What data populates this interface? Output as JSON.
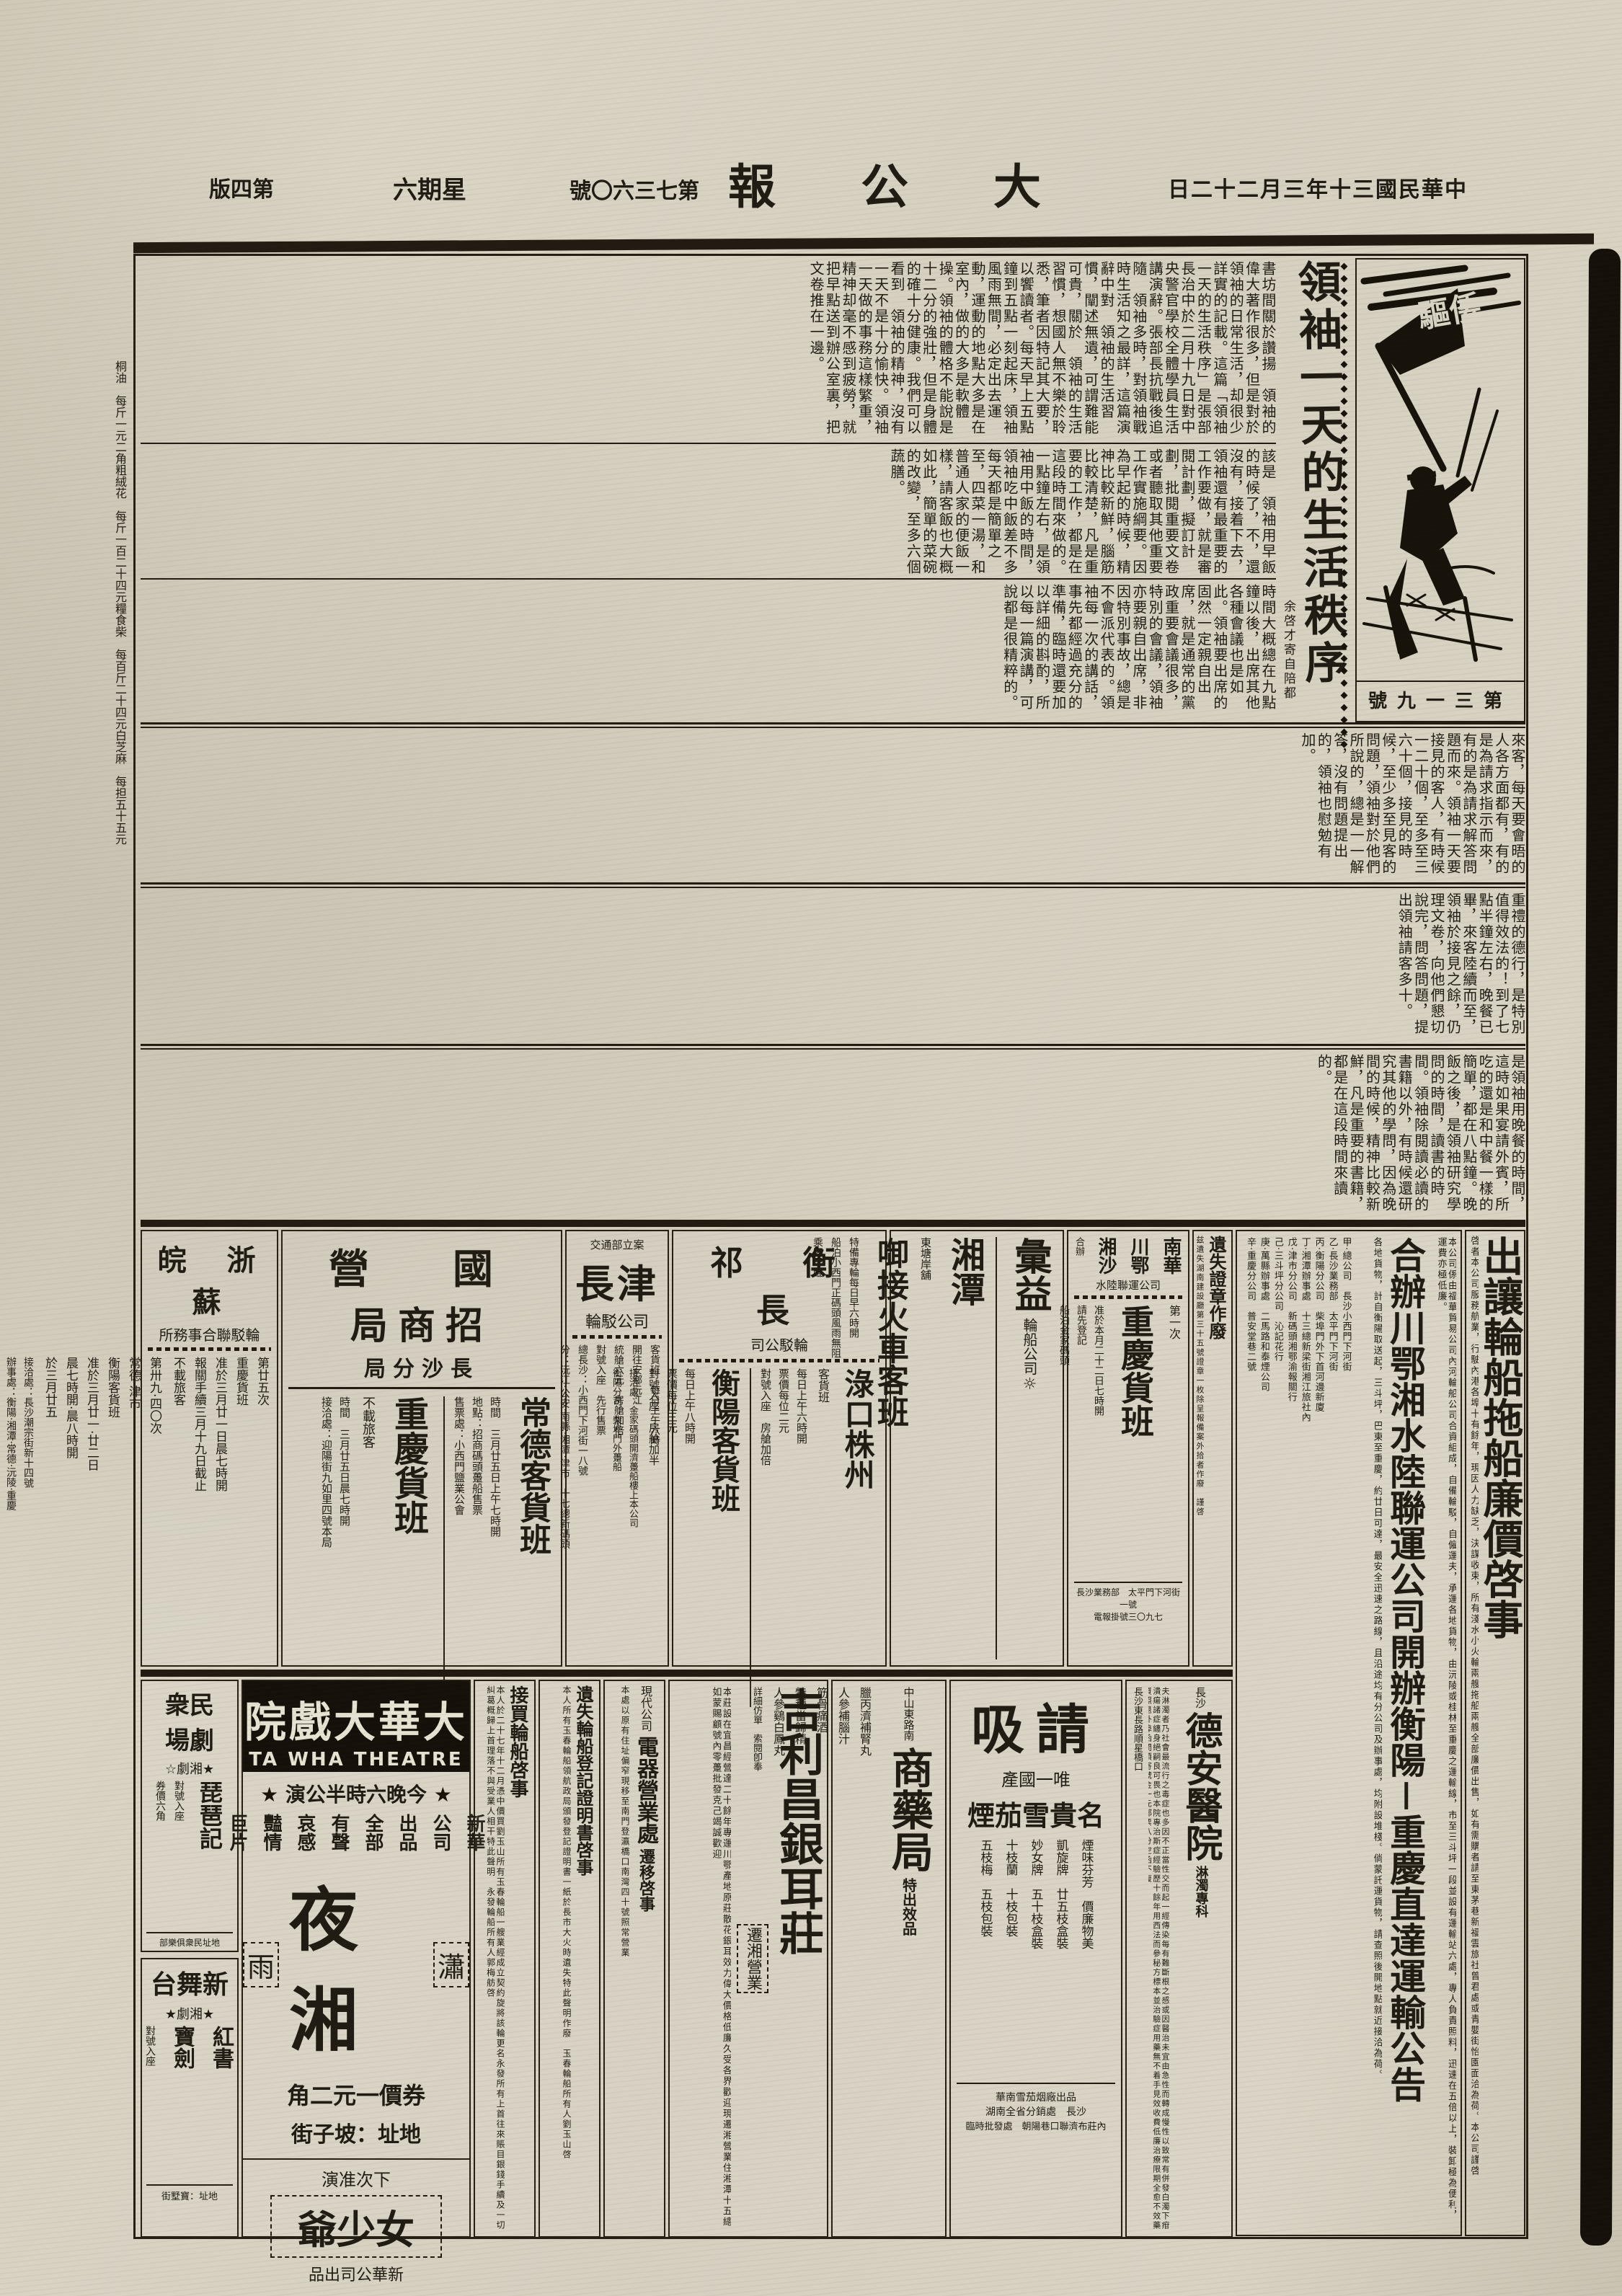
{
  "masthead": {
    "date_display": "日二十二月三年十三國民華中",
    "title_display": "報　公　大",
    "issue_display": "號〇六三七第",
    "weekday_display": "六期星",
    "edition_display": "版四第"
  },
  "prices": {
    "items": "桐油　每斤一元二角｜粗絨花　每斤一百二十四元｜糧食｜柴　每百斤二十四元｜白芝麻　每担五十五元"
  },
  "lead": {
    "headline": "領袖一天的生活秩序",
    "byline": "余啓才寄自陪都",
    "cartoon_flag": "驅倭",
    "cartoon_caption": "號九一三第",
    "row1": "書坊間關於讚揚　領袖的偉大著作很多，但是對於　領袖的日常生活，却很少詳實的記載。這篇「領袖一天的生活秩序」是張部長治中於二月十九日對中央警官學校全體學員生活講演辭。張部長抗戰後追隨　領袖多時，對領袖戰時生活知之最詳，這篇演辭中對　領袖的生活習慣，闡述無遺，可謂難能可貴，關於　領袖的生活習慣，想國人無不樂於聆悉，筆者因特記其大要，以饗讀者。每天早上五點鐘到五點一刻起床，領袖風雨無間，必定出去運動，運動的地點大多是在室內，做的大多是軟體操。領袖的體格不能說是十二分的強壯，但是身體的確十分健康。我們可以看到　領袖的精神，沒有一天不是十分愉快。領袖一天做的事務這樣繁重，精神却毫不感到疲勞，就把早點送到辦公室裏，把文卷推在一邊。",
    "row2": "該是　領袖用早飯的時候了，不，還沒有，接着下去，領袖還有最重要的工作要做，就是審閱計劃，擬訂計劃，批閱重要文卷或者聽取其他重要工作實施綱要。因為早起的時候，精神比較新鮮，腦筋比較清楚，凡是重要的工作，都是在這段時間來做的。一點鐘左右，是領袖用中飯的時間，領袖吃中飯差不多每天都是簡單之至，四菜一湯，和普通人家的便飯一樣，請客飯也大概如此，簡單的菜碗的改變，至多六個蔬膳。",
    "row3": "時間大概總在九點鐘以後，出席其他各種會議也是如此。領袖要出席的固然一定親自出席，就是通常的黨政重要會議很多，特別的會議，領袖亦要親自出席，非因特別事故，總是不會派代表的。領袖每一次的講話，事先都經過充分的準備，臨時還要加以詳細的斟酌，所以每一篇演講，可說都是很精粹的。"
  },
  "bands": {
    "b2": "來客，每天要會晤的人各方面都有，有的是為請求指示而來，有的是為請求解答問題而來。領袖一天要接見的客人，有時候一二十個，至多至三六十個，接見的時候，至少多至見客的問題，領袖對於他們所說的，總是一一解答，沒有問題提出的，領袖也慰勉有加。",
    "b3": "重禮的德行，是特別值得效法的！到了七點半鐘左右，晚餐已畢，來客陸續而至，領袖於接見之餘，仍理文卷，向他們懇切說完，問答問題，提出領袖請客多十。",
    "b4": "是領袖用晚餐的時間，這時如果宴請外賓，所吃的還是和中餐一樣的簡單，都在八點鐘。晚飯之後，是領袖研究學問的時間，讀書的時間。領袖除閱讀必讀的書籍以外，有時候還研究其他的學問，因為晚間的時候，精神比較新鮮，凡是重要的書籍，都是在這段時間來讀的。"
  },
  "right_ads": {
    "churang": {
      "headline": "出讓輪船拖船廉價啓事",
      "body": "啓者本公司服務航業，行駛內港各埠十有餘年，現因人力缺乏，決謀收束，所有淺水小火輪兩艘拖船兩艘全部廉價出售，如有需購者請至東茅巷新福雲旅社曾君處或青嬰街怡園面洽為荷。本公司謹啓"
    },
    "gonggao": {
      "intro": "本公司係由福華貿易公司內河輪船公司合資組成，自備輪駁，自僱運夫，承運各地貨物，由沅陵或桂林至重慶之運輸線，市至三斗坪一段並設有運輸站六處，專人負責照料，迅速在五倍以上，裝卸極為便利，運費亦極低廉。",
      "headline": "合辦川鄂湘水陸聯運公司開辦衡陽－重慶直達運輸公告",
      "body": "各地貨物，計自衡陽取送起，三斗坪，巴東至重慶，約廿日可達，最安全迅速之路線，且沿途均有分公司及辦事處，均附設堆棧。倘蒙託運貨物，請查照後開地點就近接洽為荷。",
      "offices": "甲·總公司　長沙小西門下河街｜乙·長沙業務部　太平門下河街｜丙·衡陽分公司　柴埠門外下首河邊新廈｜丁·湘潭辦事處　十三總新梁街湘江旅社內｜戊·津市分公司　新碼頭湘鄂渝報關行｜己·三斗坪分公司　沁記花行｜庚·萬縣辦事處　二馬路和泰煙公司｜辛·重慶分公司　普安堂巷二號"
    }
  },
  "mid_ads": {
    "suzhewan": {
      "region": "皖　浙　蘇",
      "title": "所務事合聯駁輪",
      "c1": "第廿五次｜重慶貨班｜准於三月廿一日晨七時開｜報關手續三月十九日截止｜不載旅客",
      "c2": "第卅九·四〇次｜常德·津市｜衡陽客貨班｜准於三月廿一·廿二日｜晨七時開·晨八時開｜於三月廿五",
      "c3": "接洽處：長沙潮宗街新十四號｜辦事處：衡陽·湘潭·常德·沅陵·重慶"
    },
    "zhaoshang": {
      "t1": "營　國",
      "t2": "局商招",
      "t3": "局分沙長",
      "a_title": "常德客貨班",
      "a_cols": "時間　三月廿五日上午七時開｜地點：招商碼頭躉船售票｜售票處：小西門鹽業公會",
      "b_title": "重慶貨班",
      "b_note": "不載旅客",
      "b_cols": "時間　三月廿五日晨七時開｜接洽處：迎陽街九如里四號本局"
    },
    "changjin": {
      "t1": "交通部立案",
      "t2": "長津",
      "t3": "輪駁公司",
      "cols": "客貨班　每日上午六時｜開往安鄉沅江｜統艙六元　房艙加倍｜對號入座　先行售票｜總長沙：小西門下河街一八號｜分：沅江·公安·南縣·湘潭·津市　十七總新碼頭"
    },
    "changhengqi": {
      "t1": "祁　衡　長",
      "t2": "司公駁輪",
      "a_title": "淥口株州",
      "a_tag": "客貨班",
      "a_cols": "每日上午六時開｜票價每位二元｜對號入座　房艙加倍",
      "b_title": "衡陽客貨班",
      "b_cols": "每日上午八時開｜票價每位三元｜對號入座　房艙加半",
      "c_cols": "接洽處：金家碼頭開濟躉船樓上本公司｜衡陽分司：柴埠門外躉船"
    },
    "huiyi": {
      "t1": "彙益",
      "t2": "輪船公司",
      "a_title": "湘潭",
      "a_small": "東塘岸舖",
      "b_title": "啣接火車客班",
      "cols": "特備專輪每日早六時開｜船泊小西門正碼頭風雨無阻｜乘客早臨"
    },
    "nanhua": {
      "t_cols": "南華｜川鄂｜湘沙",
      "t_small": "合辦",
      "t_sub": "水陸聯運公司",
      "a_small": "第一次",
      "a_title": "重慶貨班",
      "cols": "准於本月二十二日七時開｜請先登記｜船泊金家碼頭",
      "f1": "長沙業務部　太平門下河街一號",
      "f2": "電報掛號三〇九七"
    },
    "zhengzhang": {
      "title": "遺失證章作廢",
      "body": "兹遺失湖南建設廳第三十五號證章一枚除呈報備案外拾者作廢　謹啓"
    }
  },
  "bottom_ads": {
    "theaters": {
      "t1_r1": "衆民",
      "t1_r2": "場劇",
      "t1_tag": "☆劇湘★",
      "t1_play": "琵琶記",
      "t1_c": "對號入座｜券價六角",
      "t1_addr": "部樂俱衆民址地",
      "t2": "台舞新",
      "t2_tag": "★劇湘★",
      "t2_plays": "紅書｜寶劍",
      "t2_c": "對號入座",
      "t2_addr": "街墅寶：址地"
    },
    "dahua": {
      "banner": "院戲大華大",
      "banner_en": "TA WHA THEATRE",
      "showtime": "演公半時六晚今",
      "tags": "新華｜公司｜出品｜全部｜有聲｜哀感｜豔情｜巨片",
      "m_left": "雨",
      "m_big": "夜湘",
      "m_right": "瀟",
      "price": "角二元一價券",
      "addr": "街子坡：址地",
      "next_label": "演准次下",
      "next_title": "爺少女",
      "next_sub": "品出司公華新"
    },
    "jiemai": {
      "title": "接買輪船啓事",
      "body": "本人於二十七年十二月憑中價買劉玉山所有玉春輪船一艘業經成立契約旋將該輪更名永發所有上首往來賬目銀錢手續及一切糾葛概歸上首理落不與受業人相干特此聲明　永發輪船所有人郭梅舫啓"
    },
    "yishi2": {
      "title": "遺失輪船登記證明書啓事",
      "body": "本人所有玉春輪船領航政局頒發登記證明書一紙於長市大火時遺失特此聲明作廢　玉春輪船所有人劉玉山啓"
    },
    "dianqi": {
      "t1": "現代公司",
      "title": "電器營業處",
      "t2": "遷移啓事",
      "body": "本處以原有住址偏窄現移至南門登瀛橋口南灣四十號照常營業"
    },
    "jilichang": {
      "title": "吉利昌銀耳莊",
      "tag": "遷湘營業",
      "body": "本莊設在宜昌經營達二十餘年專運川鄂產地原莊散花銀耳效力偉大價格低廉久受各界歡迎現遷湘營業住湘潭十五總如蒙賜顧號內零躉批發克己竭誠歡迎"
    },
    "shangyao": {
      "addr": "中山東路南",
      "title": "商藥局",
      "tag": "特出效品",
      "items": "臘丙濟補腎丸｜人參補腦汁｜筋骨痛酒｜特種當歸精｜人參鷄白鳳丸",
      "note": "詳細仿單　索閱卽奉"
    },
    "qingxi": {
      "t_big": "吸請",
      "t2": "產國一唯",
      "t3": "煙茄雪貴名",
      "brands": "煙味芬芳　價廉物美｜凱旋牌　廿五枝盒裝｜妙女牌　五十枝盒裝｜十枝蘭　十枝包裝｜五枝梅　五枝包裝",
      "f1": "華南雪茄烟廠出品",
      "f2": "湖南全省分銷處　長沙",
      "f3": "臨時批發處　朝陽巷口聯濟布莊內"
    },
    "dean": {
      "t_small": "長沙",
      "title": "德安醫院",
      "tag": "淋濁專科",
      "body": "夫淋濁者乃社會最流行之毒症也多因不正當性交而起一經傳染每有難斷根之感或因醫治未宜由急性而轉成慢性以致常有併發白濁下疳潰瘍諸症纏身絕嗣良可畏也本院專治斯症經驗歷十餘年用西法而參秘方標本並治驗症用藥無不着手見效收費低廉治療限期全愈不效藥資照退外埠函問須寄號金一元郵票八分空函不復",
      "addr": "長沙東長路順星橋口"
    }
  }
}
